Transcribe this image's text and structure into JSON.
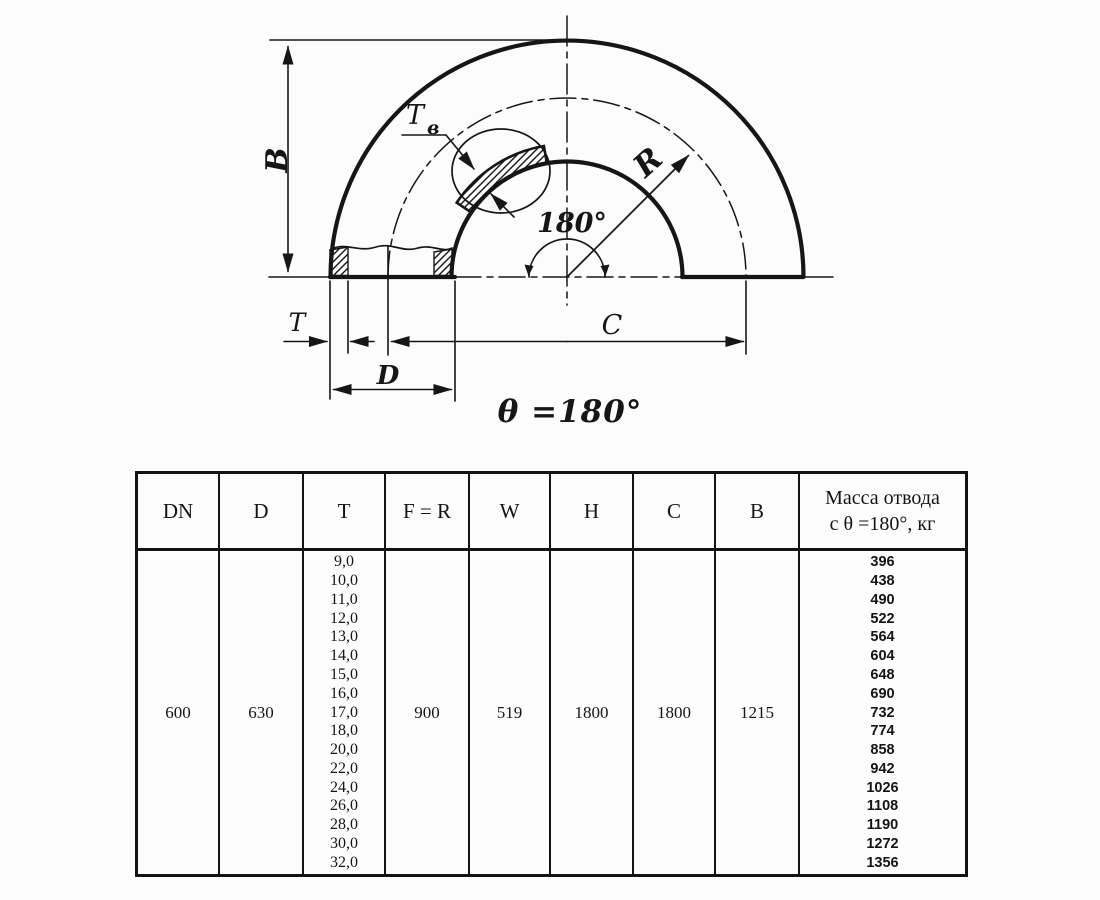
{
  "drawing": {
    "labels": {
      "B": "B",
      "T_detail_main": "T",
      "T_detail_sub": "в",
      "R": "R",
      "angle": "180°",
      "T": "T",
      "D": "D",
      "C": "C",
      "theta_equation": "θ =180°"
    }
  },
  "table": {
    "headers": {
      "dn": "DN",
      "d": "D",
      "t": "T",
      "fr": "F = R",
      "w": "W",
      "h": "H",
      "c": "C",
      "b": "B",
      "mass_line1": "Масса отвода",
      "mass_line2": "с θ =180°, кг"
    },
    "row": {
      "dn": "600",
      "d": "630",
      "fr": "900",
      "w": "519",
      "h": "1800",
      "c": "1800",
      "b": "1215"
    },
    "t_values": [
      "9,0",
      "10,0",
      "11,0",
      "12,0",
      "13,0",
      "14,0",
      "15,0",
      "16,0",
      "17,0",
      "18,0",
      "20,0",
      "22,0",
      "24,0",
      "26,0",
      "28,0",
      "30,0",
      "32,0"
    ],
    "mass_values": [
      "396",
      "438",
      "490",
      "522",
      "564",
      "604",
      "648",
      "690",
      "732",
      "774",
      "858",
      "942",
      "1026",
      "1108",
      "1190",
      "1272",
      "1356"
    ]
  },
  "colors": {
    "ink": "#161616",
    "background": "#fcfcfc"
  }
}
